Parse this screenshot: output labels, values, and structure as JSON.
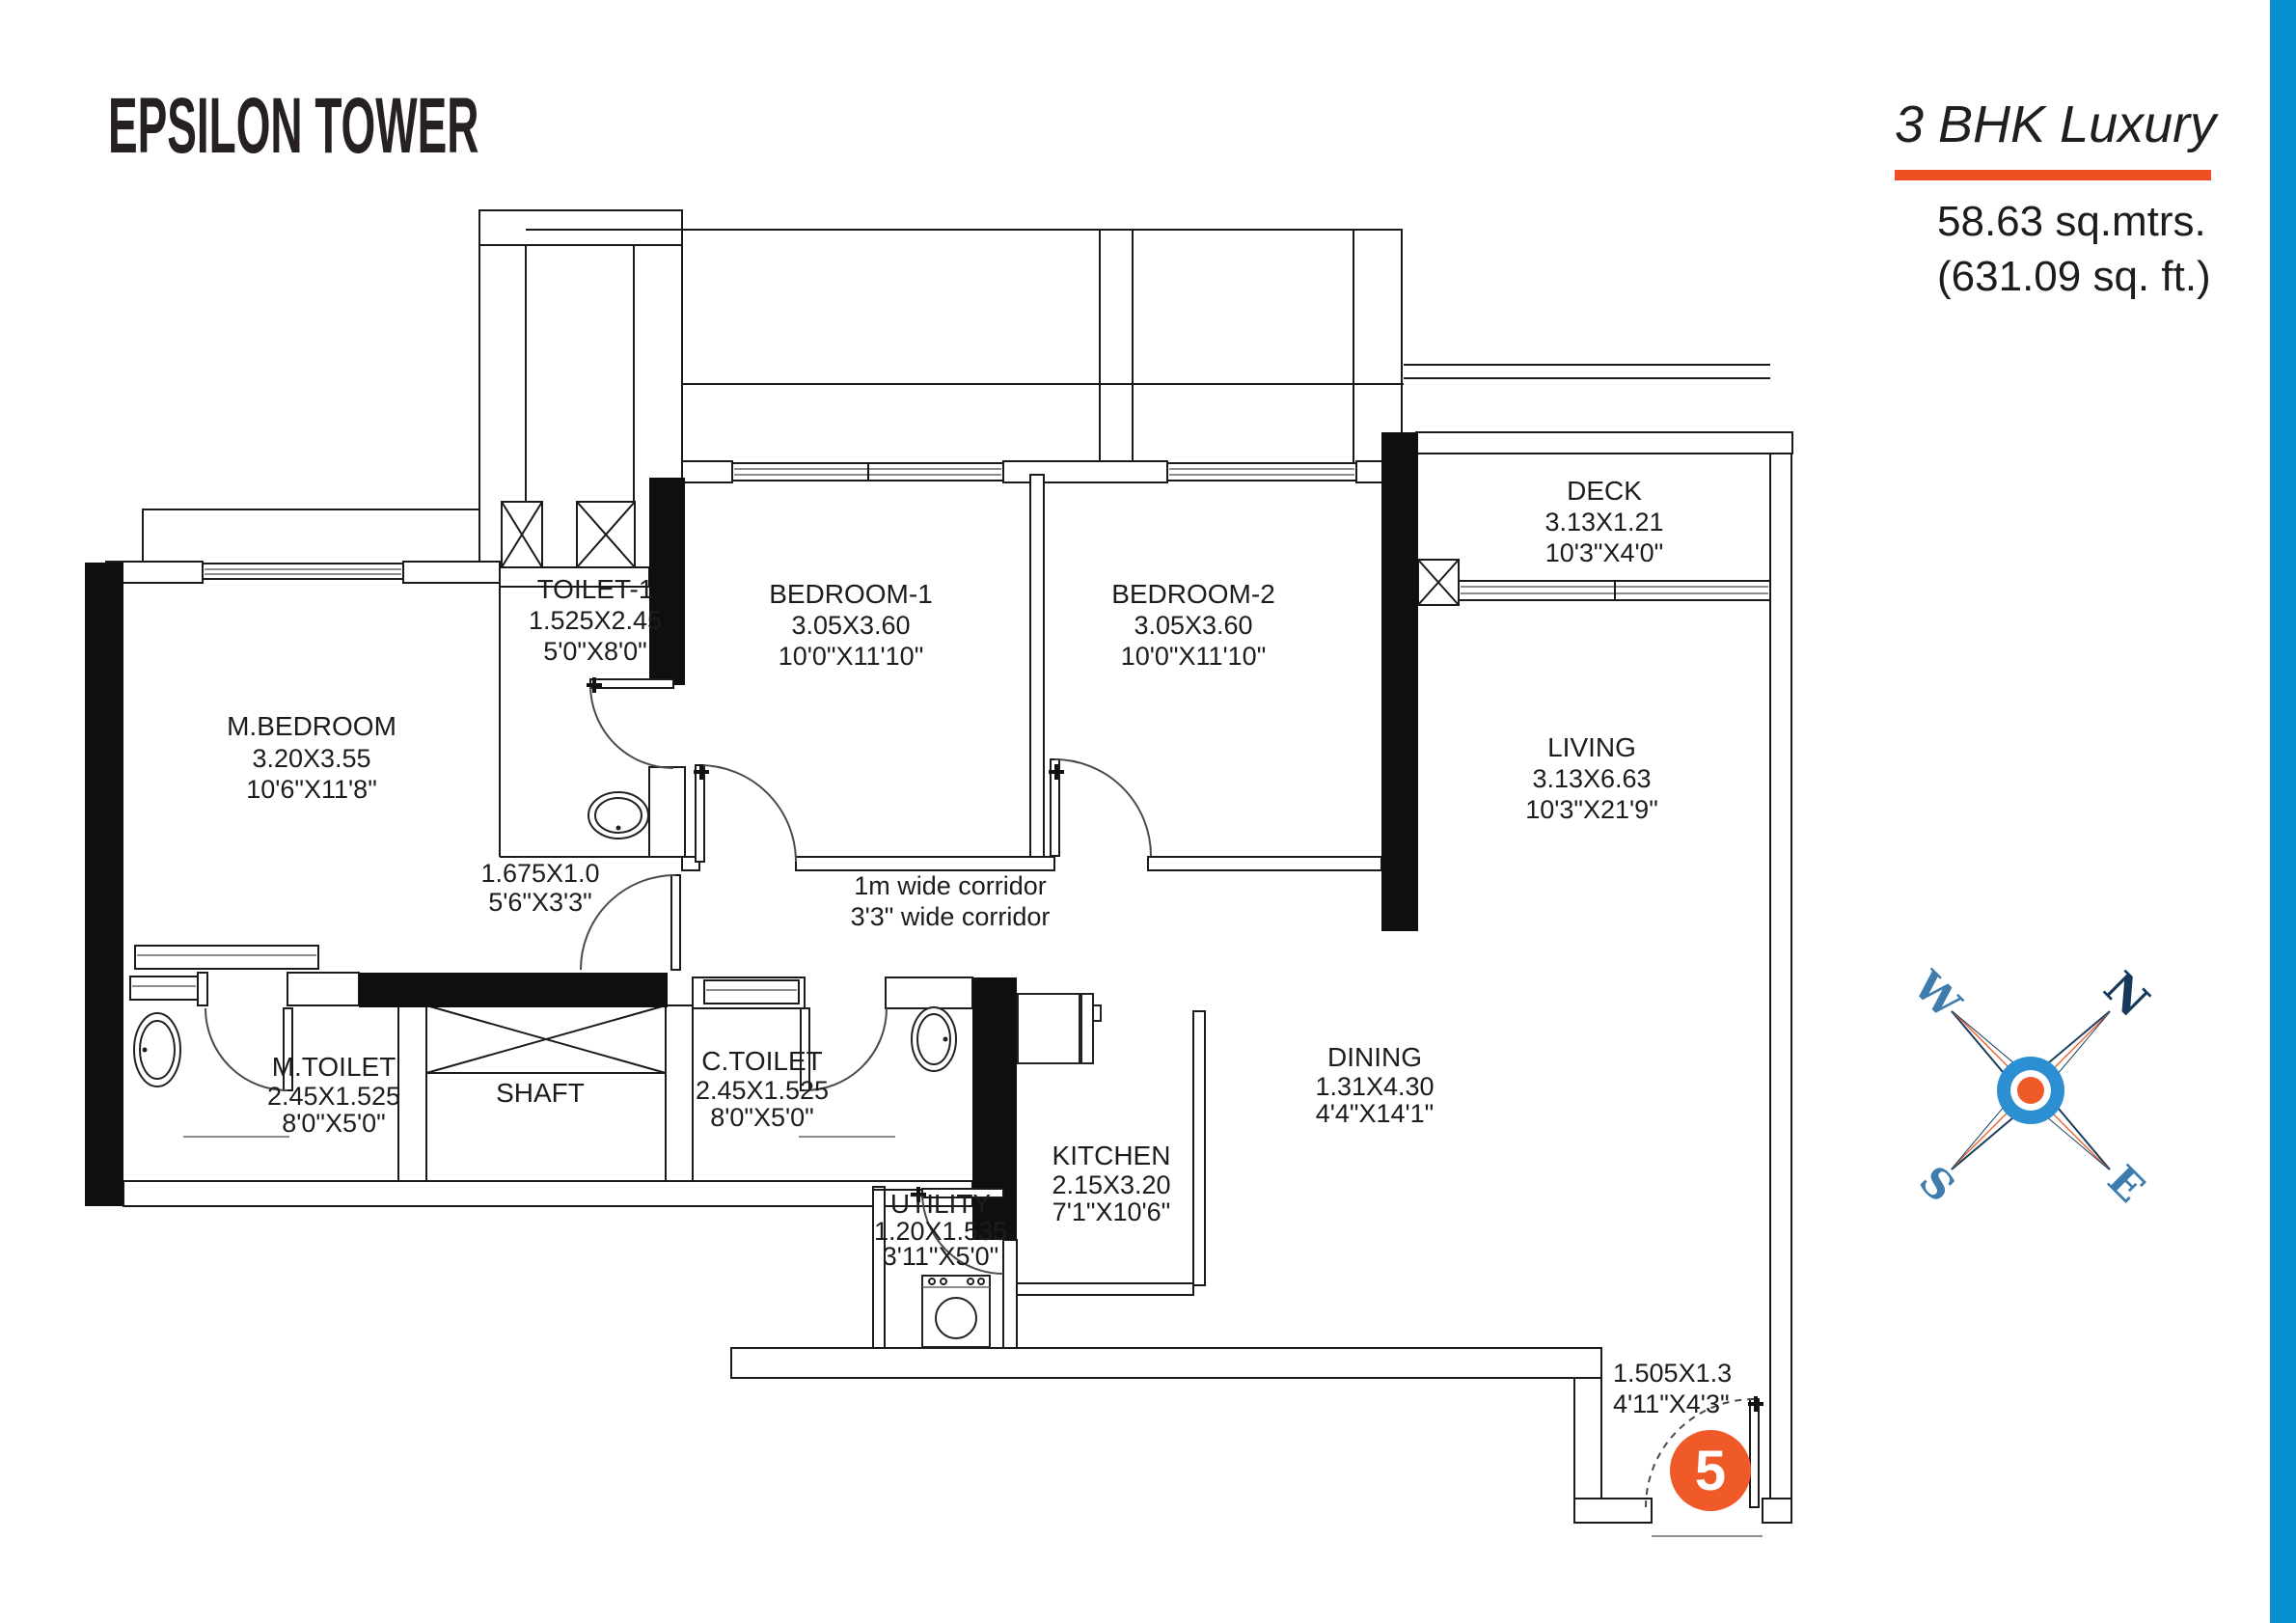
{
  "header": {
    "project_title": "EPSILON TOWER",
    "unit_type": "3 BHK Luxury",
    "area_sqm": "58.63 sq.mtrs.",
    "area_sqft": "(631.09 sq. ft.)"
  },
  "colors": {
    "accent_orange": "#F04E23",
    "badge_orange": "#F05A28",
    "side_bar_blue": "#0891D0",
    "compass_navy": "#16395B",
    "compass_blue": "#3E7CAE",
    "wall_black": "#0f0f0f"
  },
  "plan": {
    "rooms": [
      {
        "name": "M.BEDROOM",
        "dim_m": "3.20X3.55",
        "dim_ft": "10'6\"X11'8\""
      },
      {
        "name": "TOILET-1",
        "dim_m": "1.525X2.45",
        "dim_ft": "5'0\"X8'0\""
      },
      {
        "name": "BEDROOM-1",
        "dim_m": "3.05X3.60",
        "dim_ft": "10'0\"X11'10\""
      },
      {
        "name": "BEDROOM-2",
        "dim_m": "3.05X3.60",
        "dim_ft": "10'0\"X11'10\""
      },
      {
        "name": "DECK",
        "dim_m": "3.13X1.21",
        "dim_ft": "10'3\"X4'0\""
      },
      {
        "name": "LIVING",
        "dim_m": "3.13X6.63",
        "dim_ft": "10'3\"X21'9\""
      },
      {
        "name": "M.TOILET",
        "dim_m": "2.45X1.525",
        "dim_ft": "8'0\"X5'0\""
      },
      {
        "name": "SHAFT",
        "dim_m": "",
        "dim_ft": ""
      },
      {
        "name": "C.TOILET",
        "dim_m": "2.45X1.525",
        "dim_ft": "8'0\"X5'0\""
      },
      {
        "name": "KITCHEN",
        "dim_m": "2.15X3.20",
        "dim_ft": "7'1\"X10'6\""
      },
      {
        "name": "UTILITY",
        "dim_m": "1.20X1.535",
        "dim_ft": "3'11\"X5'0\""
      },
      {
        "name": "DINING",
        "dim_m": "1.31X4.30",
        "dim_ft": "4'4\"X14'1\""
      }
    ],
    "passage": {
      "dim_m": "1.675X1.0",
      "dim_ft": "5'6\"X3'3\""
    },
    "corridor": {
      "line1": "1m wide corridor",
      "line2": "3'3\" wide corridor"
    },
    "entry": {
      "dim_m": "1.505X1.3",
      "dim_ft": "4'11\"X4'3\"",
      "unit_number": "5"
    }
  },
  "compass": {
    "north": "N",
    "south": "S",
    "east": "E",
    "west": "W"
  }
}
